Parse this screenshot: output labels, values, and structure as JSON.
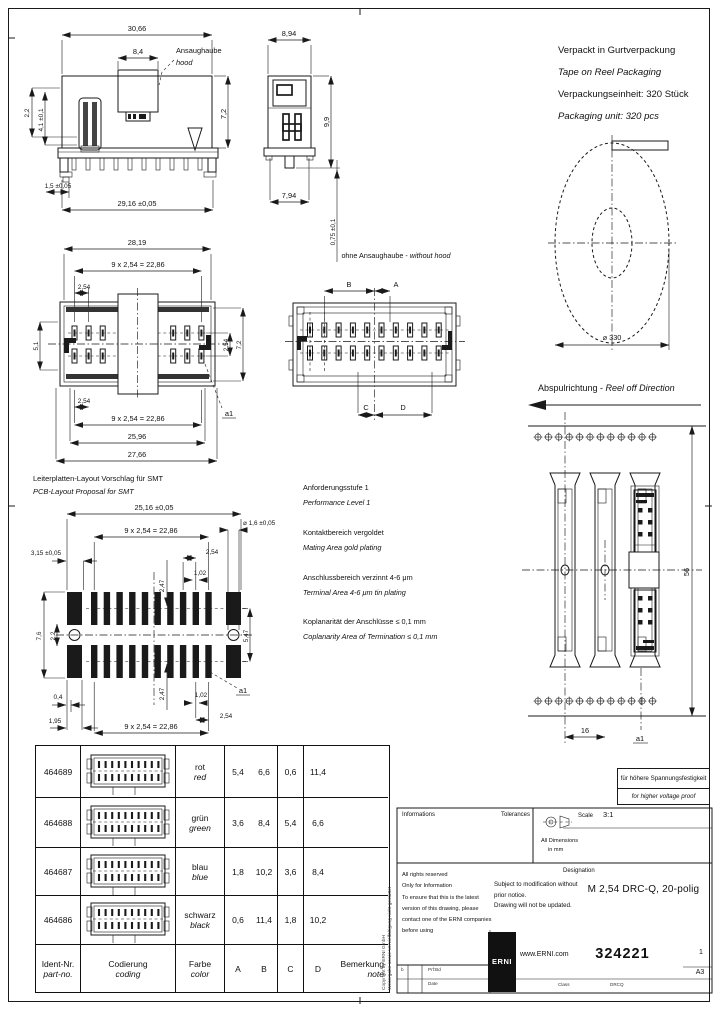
{
  "packaging": {
    "de1": "Verpackt in Gurtverpackung",
    "en1": "Tape on Reel Packaging",
    "de2": "Verpackungseinheit:  320 Stück",
    "en2": "Packaging unit:  320 pcs"
  },
  "reel": {
    "diameter": "⌀ 330",
    "direction_de": "Abspulrichtung - ",
    "direction_en": "Reel off Direction"
  },
  "labels": {
    "hood_de": "Ansaughaube",
    "hood_en": "hood",
    "without_hood_de": "ohne Ansaughaube - ",
    "without_hood_en": "without hood",
    "smt_de": "Leiterplatten-Layout Vorschlag für SMT",
    "smt_en": "PCB-Layout Proposal for SMT",
    "a1": "a1",
    "A": "A",
    "B": "B",
    "C": "C",
    "D": "D"
  },
  "dims": {
    "side_overall": "30,66",
    "hood_width": "8,4",
    "side_h1": "2,2",
    "side_h2": "4,1 ±0,1",
    "side_height": "7,2",
    "pin_offset": "1,5 ±0,05",
    "side_bottom": "29,16 ±0,05",
    "end_width": "8,94",
    "end_height": "9,9",
    "end_bottom": "7,94",
    "end_standoff": "0,75 ±0,1",
    "top_overall": "28,19",
    "pitch_row": "9 x 2,54 = 22,86",
    "pitch": "2,54",
    "top_b1": "25,96",
    "top_b2": "27,66",
    "top_left": "5,1",
    "top_r2": "7,2",
    "smt_overall": "25,16 ±0,05",
    "smt_hole": "⌀ 1,6 ±0,05",
    "smt_left": "3,15 ±0,05",
    "smt_v": "2,47",
    "smt_pad_w": "1,02",
    "smt_h1": "7,6",
    "smt_h2": "2,2",
    "smt_h3": "5,47",
    "smt_b1": "0,4",
    "smt_b2": "1,95",
    "tape_width": "56",
    "tape_pitch": "16"
  },
  "notes": [
    {
      "de": "Anforderungsstufe 1",
      "en": "Performance Level 1"
    },
    {
      "de": "Kontaktbereich vergoldet",
      "en": "Mating Area gold plating"
    },
    {
      "de": "Anschlussbereich verzinnt 4-6 μm",
      "en": "Terminal Area 4-6 μm tin plating"
    },
    {
      "de": "Koplanarität der Anschlüsse ≤ 0,1 mm",
      "en": "Coplanarity Area of Termination ≤ 0,1 mm"
    }
  ],
  "voltage_box": {
    "de": "für höhere Spannungsfestigkeit",
    "en": "for higher voltage proof"
  },
  "table": {
    "headers": {
      "ident_de": "Ident-Nr.",
      "ident_en": "part-no.",
      "coding_de": "Codierung",
      "coding_en": "coding",
      "color_de": "Farbe",
      "color_en": "color",
      "a": "A",
      "b": "B",
      "c": "C",
      "d": "D",
      "note_de": "Bemerkung",
      "note_en": "note"
    },
    "rows": [
      {
        "part": "464689",
        "color_de": "rot",
        "color_en": "red",
        "a": "5,4",
        "b": "6,6",
        "c": "0,6",
        "d": "11,4",
        "note": ""
      },
      {
        "part": "464688",
        "color_de": "grün",
        "color_en": "green",
        "a": "3,6",
        "b": "8,4",
        "c": "5,4",
        "d": "6,6",
        "note": ""
      },
      {
        "part": "464687",
        "color_de": "blau",
        "color_en": "blue",
        "a": "1,8",
        "b": "10,2",
        "c": "3,6",
        "d": "8,4",
        "note": ""
      },
      {
        "part": "464686",
        "color_de": "schwarz",
        "color_en": "black",
        "a": "0,6",
        "b": "11,4",
        "c": "1,8",
        "d": "10,2",
        "note": ""
      }
    ]
  },
  "titleblock": {
    "informations": "Informations",
    "tolerances": "Tolerances",
    "scale_label": "Scale",
    "scale_value": "3:1",
    "dims_note1": "All Dimensions",
    "dims_note2": "in mm",
    "legal1": "All rights reserved",
    "legal2": "Only for Information",
    "legal3": "To ensure that this is the latest",
    "legal4": "version of this drawing, please",
    "legal5": "contact one of the ERNI companies",
    "legal6": "before using",
    "mod1": "Subject to modification without",
    "mod2": "prior notice.",
    "mod3": "Drawing will not be updated.",
    "designation_label": "Designation",
    "designation": "M 2,54 DRC-Q, 20-polig",
    "logo": "ERNI",
    "website": "www.ERNI.com",
    "part_number": "324221",
    "sheet": "1",
    "format": "A3",
    "field_b": "b",
    "field_name": "Prf:Bd",
    "field_date": "Date",
    "field_class": "Class",
    "field_class_value": "DRCQ",
    "copyright1": "Copyright by ERNI GmbH",
    "copyright2": "Weitergabe sowie Vervielfältigung nicht gestattet"
  }
}
